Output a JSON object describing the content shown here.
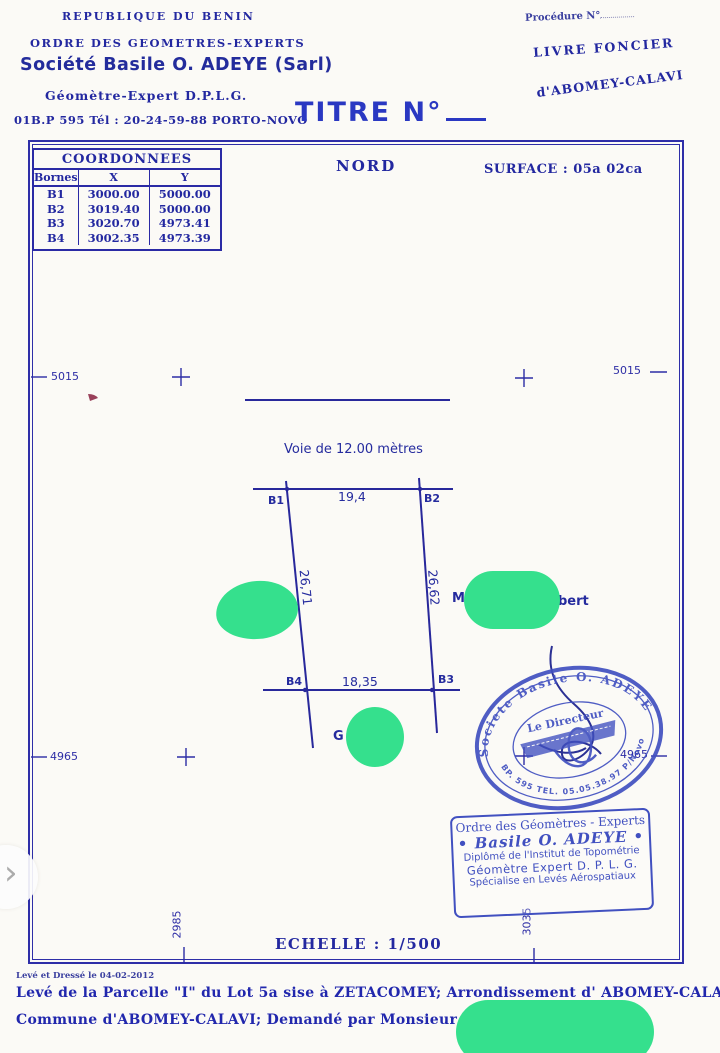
{
  "header": {
    "left": {
      "line1": "REPUBLIQUE DU BENIN",
      "line2": "ORDRE DES GEOMETRES-EXPERTS",
      "line3": "Société Basile O. ADEYE (Sarl)",
      "line4": "Géomètre-Expert D.P.L.G.",
      "line5": "01B.P 595 Tél : 20-24-59-88 PORTO-NOVO"
    },
    "right": {
      "procedure": "Procédure N°",
      "livre": "LIVRE FONCIER",
      "lieu": "d'ABOMEY-CALAVI"
    },
    "title": "TITRE N°"
  },
  "coordinates_table": {
    "title": "COORDONNEES",
    "columns": [
      "Bornes",
      "X",
      "Y"
    ],
    "rows": [
      [
        "B1",
        "3000.00",
        "5000.00"
      ],
      [
        "B2",
        "3019.40",
        "5000.00"
      ],
      [
        "B3",
        "3020.70",
        "4973.41"
      ],
      [
        "B4",
        "3002.35",
        "4973.39"
      ]
    ]
  },
  "plan": {
    "north": "NORD",
    "surface": "SURFACE : 05a 02ca",
    "road": "Voie de 12.00 mètres",
    "corners": {
      "b1": "B1",
      "b2": "B2",
      "b3": "B3",
      "b4": "B4"
    },
    "lengths": {
      "top": "19,4",
      "bottom": "18,35",
      "left": "26,71",
      "right": "26,62"
    },
    "owner_prefix": "M",
    "owner_suffix": "bert",
    "g_label": "G",
    "scale": "ECHELLE : 1/500"
  },
  "grid": {
    "left_top": "5015",
    "right_top": "5015",
    "left_bottom": "4965",
    "right_bottom": "4965",
    "bottom_left": "2985",
    "bottom_right": "3035"
  },
  "stamps": {
    "round": {
      "arc_top": "Societe Basile O. ADEYE",
      "arc_bottom": "BP. 595 TEL. 05.05.38.97 P/Novo",
      "center": "Le Directeur"
    },
    "rect": {
      "line1": "Ordre des Géomètres - Experts",
      "line2": "• Basile O. ADEYE •",
      "line3": "Diplômé de l'Institut de Topométrie",
      "line4": "Géomètre Expert D. P. L. G.",
      "line5": "Spécialise en Levés Aérospatiaux"
    }
  },
  "footer": {
    "small": "Levé et Dressé  le 04-02-2012",
    "line1": "Levé de la Parcelle \"I\" du Lot 5a sise à ZETACOMEY; Arrondissement d' ABOMEY-CALAVI",
    "line2": "Commune d'ABOMEY-CALAVI; Demandé par Monsieur KEREKOU"
  },
  "icons": {
    "chevron_next": "›"
  },
  "colors": {
    "ink": "#2328a0",
    "stamp_blue": "#4150c0",
    "redaction_green": "#35e08d",
    "paper": "#fbfaf6"
  }
}
